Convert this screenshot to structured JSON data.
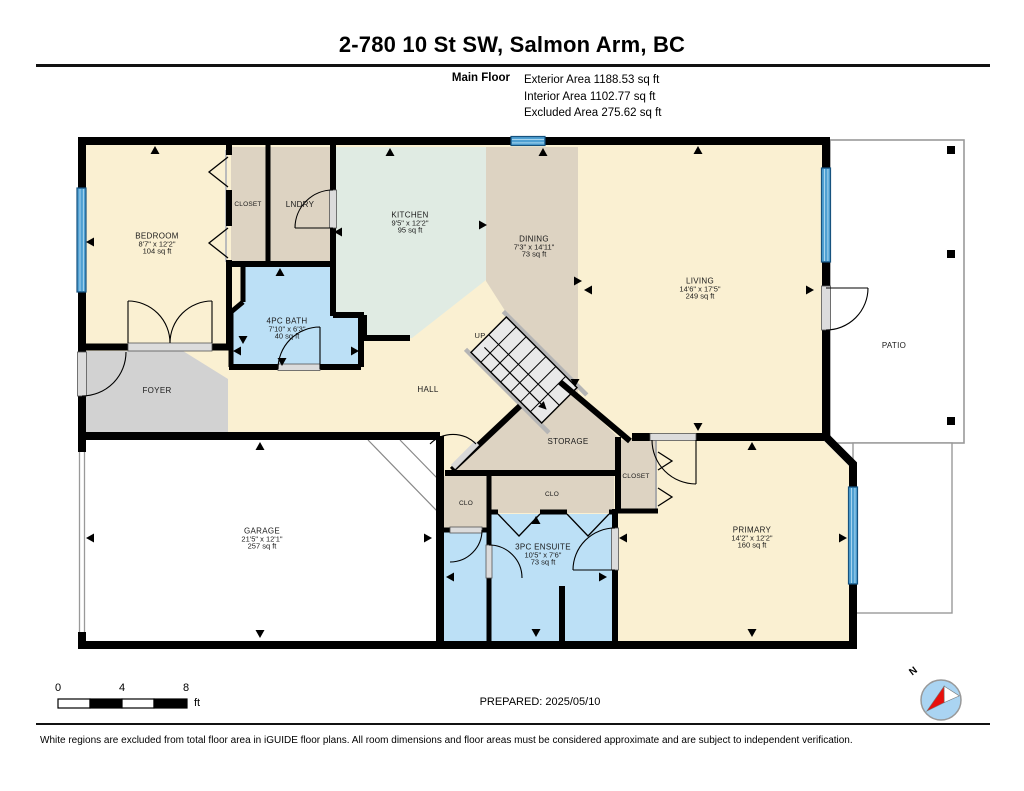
{
  "header": {
    "title": "2-780 10 St SW, Salmon Arm, BC",
    "floor_label": "Main Floor",
    "areas": [
      "Exterior Area 1188.53 sq ft",
      "Interior Area 1102.77 sq ft",
      "Excluded Area 275.62 sq ft"
    ]
  },
  "rooms": {
    "bedroom": {
      "name": "BEDROOM",
      "dims": "8'7\" x 12'2\"",
      "area": "104 sq ft"
    },
    "closet_hall": {
      "name": "CLOSET"
    },
    "laundry": {
      "name": "LNDRY"
    },
    "kitchen": {
      "name": "KITCHEN",
      "dims": "9'5\" x 12'2\"",
      "area": "95 sq ft"
    },
    "dining": {
      "name": "DINING",
      "dims": "7'3\" x 14'11\"",
      "area": "73 sq ft"
    },
    "living": {
      "name": "LIVING",
      "dims": "14'6\" x 17'5\"",
      "area": "249 sq ft"
    },
    "patio": {
      "name": "PATIO"
    },
    "bath": {
      "name": "4PC BATH",
      "dims": "7'10\" x 6'3\"",
      "area": "40 sq ft"
    },
    "foyer": {
      "name": "FOYER"
    },
    "hall": {
      "name": "HALL"
    },
    "stairs": {
      "name": "UP"
    },
    "storage": {
      "name": "STORAGE"
    },
    "closet_primary": {
      "name": "CLOSET"
    },
    "clo_small": {
      "name": "CLO"
    },
    "clo_wide": {
      "name": "CLO"
    },
    "garage": {
      "name": "GARAGE",
      "dims": "21'5\" x 12'1\"",
      "area": "257 sq ft"
    },
    "ensuite": {
      "name": "3PC ENSUITE",
      "dims": "10'5\" x 7'6\"",
      "area": "73 sq ft"
    },
    "primary": {
      "name": "PRIMARY",
      "dims": "14'2\" x 12'2\"",
      "area": "160 sq ft"
    }
  },
  "colors": {
    "room_cream": "#FAF0D2",
    "room_tan": "#DDD3C2",
    "room_mint": "#E0EBE3",
    "room_blue": "#BCE0F6",
    "room_gray": "#D2D2D2",
    "window_blue": "#4FA0D2",
    "wall_black": "#000000"
  },
  "scale_bar": {
    "t0": "0",
    "t1": "4",
    "t2": "8",
    "unit": "ft"
  },
  "prepared": "PREPARED: 2025/05/10",
  "compass": {
    "north_label": "N"
  },
  "footer": "White regions are excluded from total floor area in iGUIDE floor plans. All room dimensions and floor areas must be considered approximate and are subject to independent verification."
}
